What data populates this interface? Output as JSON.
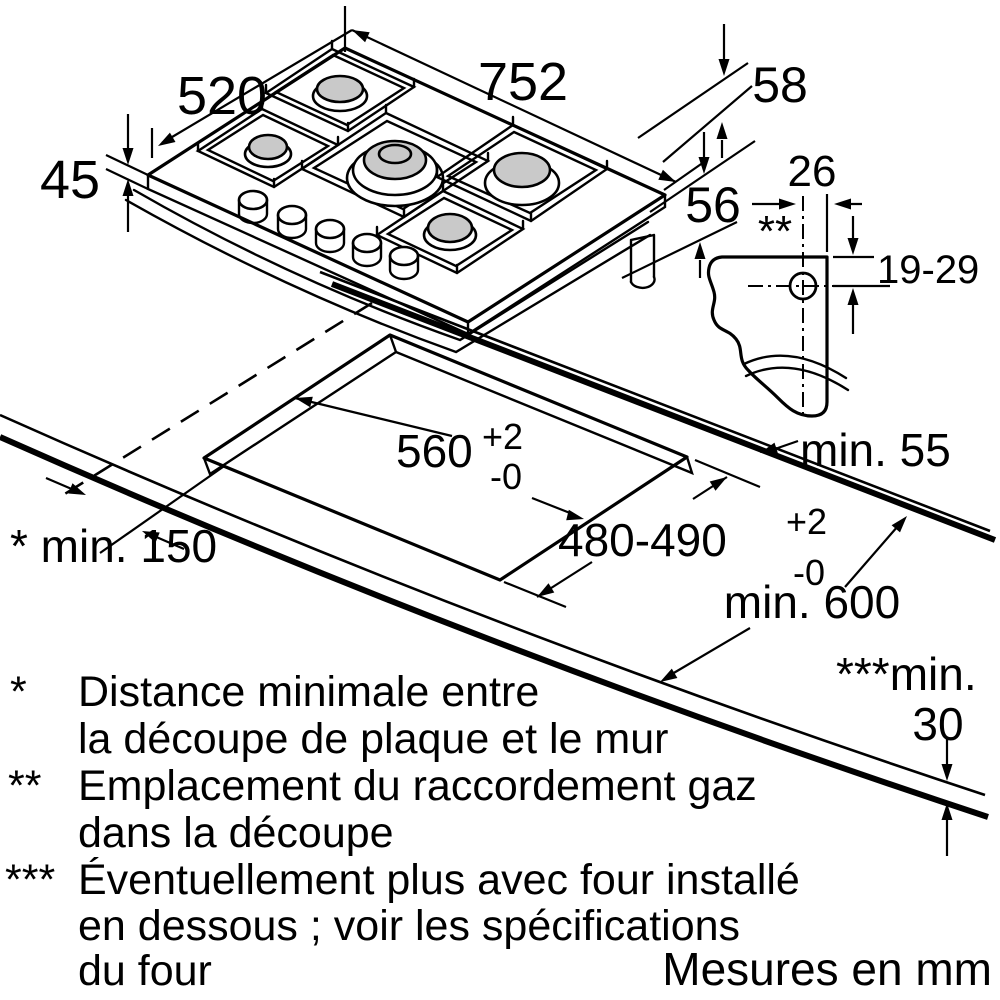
{
  "hob_dims": {
    "width": "752",
    "depth": "520",
    "thickness": "45",
    "rear_edge": "58",
    "below_height": "56"
  },
  "gas_detail": {
    "offset": "26",
    "marker": "**",
    "range": "19-29"
  },
  "cutout": {
    "width": "560",
    "width_tol_plus": "+2",
    "width_tol_minus": "-0",
    "depth": "480-490",
    "depth_tol_plus": "+2",
    "depth_tol_minus": "-0"
  },
  "clearances": {
    "wall": "* min. 150",
    "rear": "min. 55",
    "front": "min. 600",
    "board_prefix": "***min.",
    "board_value": "30"
  },
  "notes": [
    {
      "symbol": "*",
      "lines": [
        "Distance minimale entre",
        "la découpe de plaque et le mur"
      ]
    },
    {
      "symbol": "**",
      "lines": [
        "Emplacement du raccordement gaz",
        "dans la découpe"
      ]
    },
    {
      "symbol": "***",
      "lines": [
        "Éventuellement plus avec four installé",
        "en dessous ; voir les spécifications",
        "du four"
      ]
    }
  ],
  "units_note": "Mesures en mm"
}
